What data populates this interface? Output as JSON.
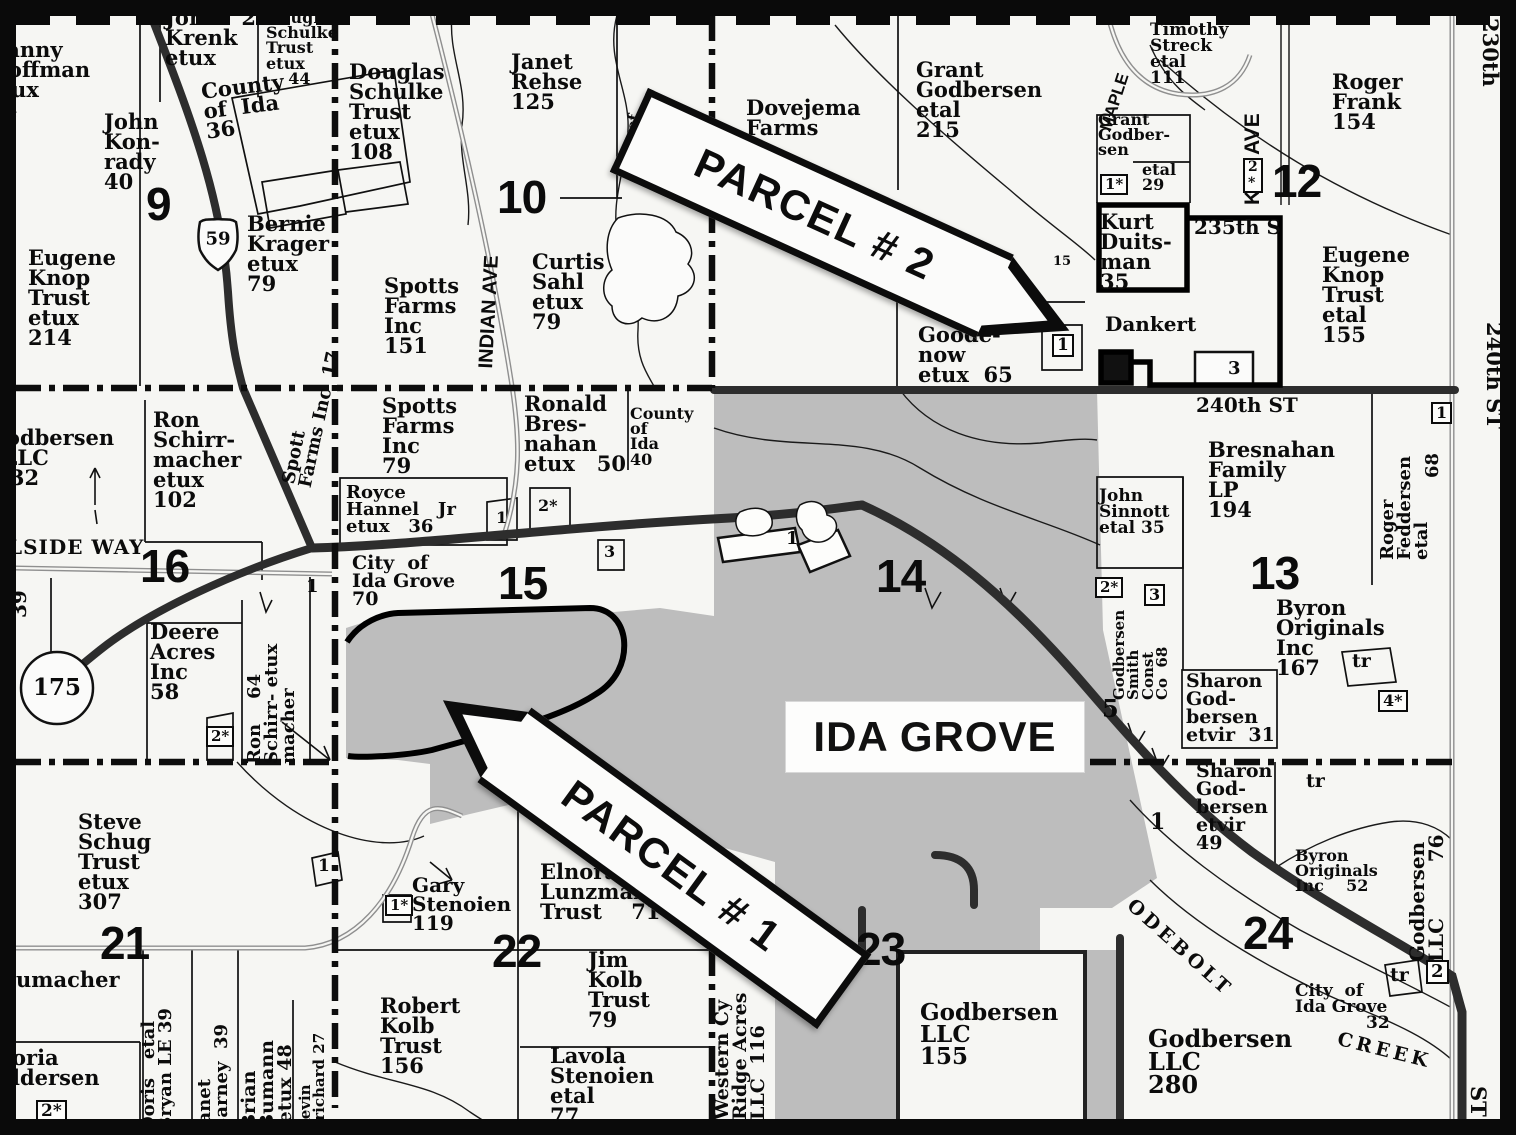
{
  "title": "Ida Grove area plat map",
  "city_label": "IDA GROVE",
  "banners": [
    {
      "id": "parcel-2",
      "label": "PARCEL # 2"
    },
    {
      "id": "parcel-1",
      "label": "PARCEL # 1"
    }
  ],
  "colors": {
    "city_fill": "#bdbdbd",
    "road_dark": "#2d2d2d",
    "road_gray": "#8f8f8f",
    "paper": "#f6f6f3",
    "ink": "#0b0b0b"
  },
  "labels": [
    {
      "id": "danny-hoffman",
      "text": "Danny\nHoffman\netux\n44",
      "x": -12,
      "y": 40,
      "fs": 21
    },
    {
      "id": "john-krenk",
      "text": "John   21\nKrenk\netux",
      "x": 165,
      "y": 8,
      "fs": 21
    },
    {
      "id": "douglas-schulke-44",
      "text": "Douglas\nSchulke\nTrust\netux\n    44",
      "x": 266,
      "y": 10,
      "fs": 16
    },
    {
      "id": "county-of-ida-36",
      "text": "County\nof  Ida\n36",
      "x": 200,
      "y": 82,
      "fs": 21,
      "rot": -7
    },
    {
      "id": "john-konrady",
      "text": "John\nKon-\nrady\n40",
      "x": 104,
      "y": 112,
      "fs": 21
    },
    {
      "id": "section-9",
      "text": "9",
      "x": 146,
      "y": 183,
      "fs": 46,
      "cls": "big"
    },
    {
      "id": "eugene-knop-214",
      "text": "Eugene\nKnop\nTrust\netux\n214",
      "x": 28,
      "y": 248,
      "fs": 21
    },
    {
      "id": "bernie-krager",
      "text": "Bernie\nKrager\netux\n79",
      "x": 247,
      "y": 214,
      "fs": 21
    },
    {
      "id": "douglas-schulke-108",
      "text": "Douglas\nSchulke\nTrust\netux\n108",
      "x": 349,
      "y": 62,
      "fs": 21
    },
    {
      "id": "janet-rehse",
      "text": "Janet\nRehse\n125",
      "x": 511,
      "y": 52,
      "fs": 21
    },
    {
      "id": "section-10",
      "text": "10",
      "x": 497,
      "y": 176,
      "fs": 46,
      "cls": "big"
    },
    {
      "id": "indian-ave",
      "text": "INDIAN AVE",
      "x": 477,
      "y": 368,
      "fs": 20,
      "cls": "sans",
      "rot": -87
    },
    {
      "id": "curtis-sahl",
      "text": "Curtis\nSahl\netux\n79",
      "x": 532,
      "y": 252,
      "fs": 21
    },
    {
      "id": "spotts-farms-151",
      "text": "Spotts\nFarms\nInc\n151",
      "x": 384,
      "y": 276,
      "fs": 21
    },
    {
      "id": "creek-ty-of",
      "text": "ty of",
      "x": 621,
      "y": 150,
      "fs": 15,
      "rot": -80
    },
    {
      "id": "dovejema-farms",
      "text": "Dovejema\nFarms",
      "x": 746,
      "y": 98,
      "fs": 21
    },
    {
      "id": "grant-godbersen-215",
      "text": "Grant\nGodbersen\netal\n215",
      "x": 916,
      "y": 60,
      "fs": 21
    },
    {
      "id": "goodenow-65",
      "text": "Goode-\nnow\netux  65",
      "x": 918,
      "y": 325,
      "fs": 21
    },
    {
      "id": "box-1-goodenow",
      "text": "1",
      "x": 1052,
      "y": 334,
      "fs": 17,
      "cls": "box"
    },
    {
      "id": "dankert",
      "text": "Dankert",
      "x": 1105,
      "y": 315,
      "fs": 20
    },
    {
      "id": "num-3-dankert",
      "text": "3",
      "x": 1228,
      "y": 360,
      "fs": 18
    },
    {
      "id": "num-15-small",
      "text": "15",
      "x": 1053,
      "y": 256,
      "fs": 13
    },
    {
      "id": "kurt-duitsman",
      "text": "Kurt\nDuits-\nman\n35",
      "x": 1100,
      "y": 212,
      "fs": 21
    },
    {
      "id": "street-235th",
      "text": "235th S",
      "x": 1194,
      "y": 218,
      "fs": 20
    },
    {
      "id": "maple-ave",
      "text": "MAPLE",
      "x": 1098,
      "y": 128,
      "fs": 17,
      "cls": "sans",
      "rot": -72
    },
    {
      "id": "timothy-streck",
      "text": "Timothy\nStreck\netal\n111",
      "x": 1150,
      "y": 22,
      "fs": 17
    },
    {
      "id": "grant-godbersen-29",
      "text": "Grant\nGodber-\nsen",
      "x": 1098,
      "y": 112,
      "fs": 16
    },
    {
      "id": "box-1star-grant",
      "text": "1*",
      "x": 1100,
      "y": 174,
      "fs": 15,
      "cls": "box"
    },
    {
      "id": "etal-29",
      "text": "etal\n29",
      "x": 1142,
      "y": 162,
      "fs": 16
    },
    {
      "id": "kilt-ave",
      "text": "KILT AVE",
      "x": 1243,
      "y": 205,
      "fs": 21,
      "cls": "sans",
      "rot": -90
    },
    {
      "id": "box-2star-kilt",
      "text": "2\n*",
      "x": 1243,
      "y": 158,
      "fs": 14,
      "cls": "box"
    },
    {
      "id": "section-12",
      "text": "12",
      "x": 1272,
      "y": 160,
      "fs": 46,
      "cls": "big"
    },
    {
      "id": "street-230th",
      "text": "230th",
      "x": 1500,
      "y": 18,
      "fs": 21,
      "rot": 90
    },
    {
      "id": "roger-frank",
      "text": "Roger\nFrank\n154",
      "x": 1332,
      "y": 72,
      "fs": 21
    },
    {
      "id": "eugene-knop-155",
      "text": "Eugene\nKnop\nTrust\netal\n155",
      "x": 1322,
      "y": 245,
      "fs": 21
    },
    {
      "id": "street-240th",
      "text": "240th ST",
      "x": 1196,
      "y": 396,
      "fs": 20
    },
    {
      "id": "street-240th-vert",
      "text": "240th ST",
      "x": 1504,
      "y": 322,
      "fs": 21,
      "rot": 90
    },
    {
      "id": "box-1-feddersen",
      "text": "1",
      "x": 1431,
      "y": 402,
      "fs": 16,
      "cls": "box"
    },
    {
      "id": "bresnahan-family",
      "text": "Bresnahan\nFamily\nLP\n194",
      "x": 1208,
      "y": 440,
      "fs": 21
    },
    {
      "id": "john-sinnott",
      "text": "John\nSinnott\netal 35",
      "x": 1099,
      "y": 488,
      "fs": 17
    },
    {
      "id": "roger-feddersen",
      "text": "Roger\nFeddersen\netal",
      "x": 1379,
      "y": 560,
      "fs": 18,
      "rot": -90
    },
    {
      "id": "feddersen-68",
      "text": "68",
      "x": 1424,
      "y": 478,
      "fs": 18,
      "rot": -90
    },
    {
      "id": "section-13",
      "text": "13",
      "x": 1250,
      "y": 552,
      "fs": 46,
      "cls": "big"
    },
    {
      "id": "box-2star-sinnott",
      "text": "2*",
      "x": 1095,
      "y": 577,
      "fs": 15,
      "cls": "box"
    },
    {
      "id": "box-3-sinnott",
      "text": "3",
      "x": 1144,
      "y": 584,
      "fs": 16,
      "cls": "box"
    },
    {
      "id": "godbersen-smith",
      "text": "Godbersen\nSmith\nConst\nCo  68",
      "x": 1112,
      "y": 700,
      "fs": 15,
      "rot": -90
    },
    {
      "id": "byron-originals-167",
      "text": "Byron\nOriginals\nInc\n167",
      "x": 1276,
      "y": 598,
      "fs": 21
    },
    {
      "id": "sharon-godbersen-31",
      "text": "Sharon\nGod-\nbersen\netvir  31",
      "x": 1186,
      "y": 672,
      "fs": 19
    },
    {
      "id": "tr-1",
      "text": "tr",
      "x": 1352,
      "y": 652,
      "fs": 19
    },
    {
      "id": "box-4star",
      "text": "4*",
      "x": 1378,
      "y": 690,
      "fs": 16,
      "cls": "box"
    },
    {
      "id": "num-5",
      "text": "5",
      "x": 1102,
      "y": 698,
      "fs": 24
    },
    {
      "id": "sharon-godbersen-49",
      "text": "Sharon\nGod-\nbersen\netvir\n49",
      "x": 1196,
      "y": 762,
      "fs": 19
    },
    {
      "id": "num-1-sharon",
      "text": "1",
      "x": 1150,
      "y": 812,
      "fs": 22
    },
    {
      "id": "tr-2",
      "text": "tr",
      "x": 1306,
      "y": 772,
      "fs": 19
    },
    {
      "id": "byron-originals-52",
      "text": "Byron\nOriginals\nInc    52",
      "x": 1295,
      "y": 848,
      "fs": 16
    },
    {
      "id": "godbersen-76",
      "text": "Godbersen\nLLC        76",
      "x": 1408,
      "y": 962,
      "fs": 20,
      "rot": -90
    },
    {
      "id": "odebolt",
      "text": "ODEBOLT",
      "x": 1136,
      "y": 896,
      "fs": 19,
      "rot": 42,
      "ls": 4
    },
    {
      "id": "creek",
      "text": "CREEK",
      "x": 1340,
      "y": 1030,
      "fs": 19,
      "rot": 14,
      "ls": 4
    },
    {
      "id": "city-of-ida-grove-32",
      "text": "City  of\nIda Grove\n            32",
      "x": 1295,
      "y": 983,
      "fs": 17
    },
    {
      "id": "godbersen-280",
      "text": "Godbersen\nLLC\n280",
      "x": 1148,
      "y": 1028,
      "fs": 24
    },
    {
      "id": "tr-3",
      "text": "tr",
      "x": 1390,
      "y": 966,
      "fs": 19
    },
    {
      "id": "box-2-right",
      "text": "2",
      "x": 1426,
      "y": 960,
      "fs": 18,
      "cls": "box"
    },
    {
      "id": "street-st-bottom",
      "text": "ST",
      "x": 1488,
      "y": 1086,
      "fs": 21,
      "rot": 90
    },
    {
      "id": "section-24",
      "text": "24",
      "x": 1243,
      "y": 912,
      "fs": 46,
      "cls": "big"
    },
    {
      "id": "section-23",
      "text": "23",
      "x": 856,
      "y": 928,
      "fs": 46,
      "cls": "big"
    },
    {
      "id": "godbersen-155",
      "text": "Godbersen\nLLC\n155",
      "x": 920,
      "y": 1002,
      "fs": 23
    },
    {
      "id": "western-cy-ridge",
      "text": "Western Cy\nRidge Acres\nLLC  116",
      "x": 713,
      "y": 1120,
      "fs": 19,
      "rot": -90
    },
    {
      "id": "lavola-stenoien",
      "text": "Lavola\nStenoien\netal\n77",
      "x": 550,
      "y": 1046,
      "fs": 21
    },
    {
      "id": "jim-kolb",
      "text": "Jim\nKolb\nTrust\n79",
      "x": 588,
      "y": 950,
      "fs": 21
    },
    {
      "id": "elnora-lunzman",
      "text": "Elnora\nLunzman\nTrust    71",
      "x": 540,
      "y": 862,
      "fs": 21
    },
    {
      "id": "section-22",
      "text": "22",
      "x": 492,
      "y": 930,
      "fs": 46,
      "cls": "big"
    },
    {
      "id": "robert-kolb",
      "text": "Robert\nKolb\nTrust\n156",
      "x": 380,
      "y": 996,
      "fs": 21
    },
    {
      "id": "gary-stenoien",
      "text": "Gary\nStenoien\n119",
      "x": 412,
      "y": 876,
      "fs": 20
    },
    {
      "id": "box-1star-gary",
      "text": "1*",
      "x": 385,
      "y": 895,
      "fs": 15,
      "cls": "box"
    },
    {
      "id": "steve-schug",
      "text": "Steve\nSchug\nTrust\netux\n307",
      "x": 78,
      "y": 812,
      "fs": 21
    },
    {
      "id": "section-21",
      "text": "21",
      "x": 100,
      "y": 922,
      "fs": 46,
      "cls": "big"
    },
    {
      "id": "schumacher-fragment",
      "text": "umacher",
      "x": 16,
      "y": 970,
      "fs": 21
    },
    {
      "id": "andersen-fragment",
      "text": "oria\nldersen",
      "x": 12,
      "y": 1048,
      "fs": 21
    },
    {
      "id": "box-2star-bottomleft",
      "text": "2*",
      "x": 36,
      "y": 1100,
      "fs": 17,
      "cls": "box"
    },
    {
      "id": "doris-bryan",
      "text": "Doris   etal\nBryan LE 39",
      "x": 140,
      "y": 1132,
      "fs": 18,
      "rot": -90
    },
    {
      "id": "janet-carney",
      "text": "Janet\nCarney  39",
      "x": 196,
      "y": 1132,
      "fs": 18,
      "rot": -90
    },
    {
      "id": "brian-bumann",
      "text": "Brian\nBumann\n etux 48",
      "x": 240,
      "y": 1130,
      "fs": 19,
      "rot": -90
    },
    {
      "id": "kevin-prichard",
      "text": "Kevin\nPrichard 27",
      "x": 298,
      "y": 1132,
      "fs": 15,
      "rot": -90
    },
    {
      "id": "num-1-sec21",
      "text": "1",
      "x": 318,
      "y": 858,
      "fs": 17
    },
    {
      "id": "hillside-way",
      "text": "LSIDE WAY",
      "x": 8,
      "y": 538,
      "fs": 20,
      "ls": 1
    },
    {
      "id": "num-39",
      "text": "39",
      "x": 10,
      "y": 618,
      "fs": 20,
      "rot": -90
    },
    {
      "id": "route-175",
      "text": "175",
      "x": 57,
      "y": 688,
      "fs": 23,
      "cls": "center"
    },
    {
      "id": "route-59",
      "text": "59",
      "x": 218,
      "y": 239,
      "fs": 18,
      "cls": "center"
    },
    {
      "id": "deere-acres",
      "text": "Deere\nAcres\nInc\n58",
      "x": 150,
      "y": 622,
      "fs": 21
    },
    {
      "id": "ron-schirr-64",
      "text": "Ron    64\nSchirr- etux\nmacher",
      "x": 246,
      "y": 764,
      "fs": 18,
      "rot": -90
    },
    {
      "id": "box-2star-deere",
      "text": "2*",
      "x": 206,
      "y": 726,
      "fs": 15,
      "cls": "box"
    },
    {
      "id": "section-16",
      "text": "16",
      "x": 140,
      "y": 545,
      "fs": 46,
      "cls": "big"
    },
    {
      "id": "ron-schirrmacher-102",
      "text": "Ron\nSchirr-\nmacher\netux\n102",
      "x": 153,
      "y": 410,
      "fs": 21
    },
    {
      "id": "godbersen-llc-left",
      "text": "Godbersen\n  LLC\n   32",
      "x": -12,
      "y": 428,
      "fs": 21
    },
    {
      "id": "spott-farms-17",
      "text": "Spott\nFarms Inc  17",
      "x": 280,
      "y": 482,
      "fs": 18,
      "rot": -78
    },
    {
      "id": "spotts-farms-79",
      "text": "Spotts\nFarms\nInc\n79",
      "x": 382,
      "y": 396,
      "fs": 21
    },
    {
      "id": "royce-hannel",
      "text": "Royce\nHannel   Jr\netux   36",
      "x": 346,
      "y": 484,
      "fs": 18
    },
    {
      "id": "num-1-royce",
      "text": "1",
      "x": 496,
      "y": 510,
      "fs": 16
    },
    {
      "id": "num-2star-royce",
      "text": "2*",
      "x": 538,
      "y": 498,
      "fs": 16
    },
    {
      "id": "num-3-royce",
      "text": "3",
      "x": 604,
      "y": 544,
      "fs": 16
    },
    {
      "id": "city-of-ida-grove-70",
      "text": "City  of\nIda Grove\n70",
      "x": 352,
      "y": 554,
      "fs": 19
    },
    {
      "id": "num-1-sec16",
      "text": "1",
      "x": 306,
      "y": 578,
      "fs": 18
    },
    {
      "id": "ronald-bresnahan",
      "text": "Ronald\nBres-\nnahan\netux   50",
      "x": 524,
      "y": 394,
      "fs": 21
    },
    {
      "id": "county-of-ida-40",
      "text": "County\nof\nIda\n40",
      "x": 630,
      "y": 406,
      "fs": 16
    },
    {
      "id": "section-15",
      "text": "15",
      "x": 498,
      "y": 562,
      "fs": 46,
      "cls": "big"
    },
    {
      "id": "section-14",
      "text": "14",
      "x": 876,
      "y": 555,
      "fs": 46,
      "cls": "big"
    },
    {
      "id": "num-1-road",
      "text": "1",
      "x": 786,
      "y": 530,
      "fs": 18
    }
  ]
}
